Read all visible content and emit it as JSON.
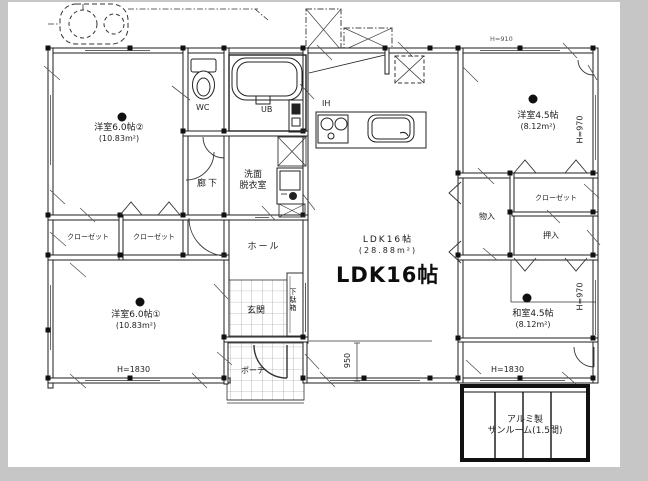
{
  "labels": {
    "western2": "洋室6.0帖②",
    "western2_area": "(10.83m²)",
    "western1": "洋室6.0帖①",
    "western1_area": "(10.83m²)",
    "western45": "洋室4.5帖",
    "western45_area": "(8.12m²)",
    "washitsu": "和室4.5帖",
    "washitsu_area": "(8.12m²)",
    "ldk": "LDK16帖",
    "ldk_area": "(28.88m²)",
    "ldk_big": "LDK16帖",
    "wc": "WC",
    "ub": "UB",
    "ih": "IH",
    "washroom1": "洗面",
    "washroom2": "脱衣室",
    "hallway": "廊下",
    "hall": "ホール",
    "entrance": "玄関",
    "shoe_cabinet": "下駄箱",
    "porch": "ポーチ",
    "closet_a": "クローゼット",
    "closet_b": "クローゼット",
    "closet_right": "クローゼット",
    "storage": "物入",
    "oshiire": "押入",
    "sunroom1": "アルミ製",
    "sunroom2": "サンルーム(1.5間)"
  },
  "dimensions": {
    "window_left": "H=1830",
    "window_right": "H=1830",
    "h970_upper": "H=970",
    "h970_lower": "H=970",
    "porch_depth": "950",
    "top_right": "H=910"
  },
  "colors": {
    "line": "#222222",
    "paper": "#ffffff",
    "frame": "#c6c6c6"
  }
}
